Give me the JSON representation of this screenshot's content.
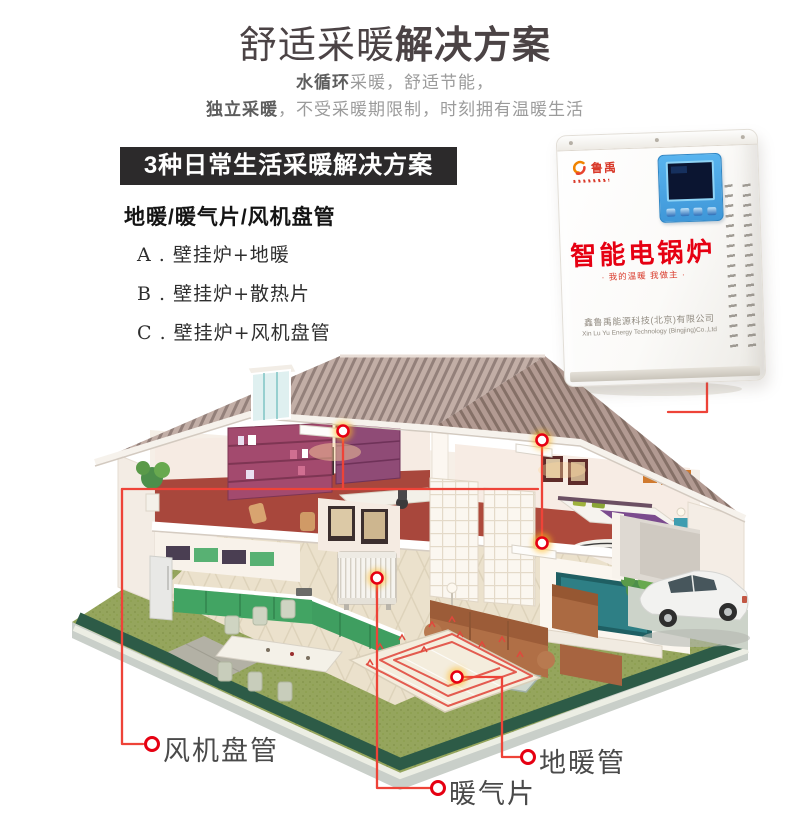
{
  "header": {
    "title_regular": "舒适采暖",
    "title_bold": "解决方案",
    "sub1_bold": "水循环",
    "sub1_rest": "采暖，舒适节能，",
    "sub2_bold": "独立采暖",
    "sub2_rest": "，不受采暖期限制，时刻拥有温暖生活"
  },
  "solutions": {
    "banner": "3种日常生活采暖解决方案",
    "subheading": "地暖/暖气片/风机盘管",
    "items": [
      "A . 壁挂炉+地暖",
      "B . 壁挂炉+散热片",
      "C . 壁挂炉+风机盘管"
    ]
  },
  "boiler": {
    "brand": "鲁禹",
    "product_name": "智能电锅炉",
    "slogan": "· 我的温暖 我做主 ·",
    "company_cn": "鑫鲁禹能源科技(北京)有限公司",
    "company_en": "Xin Lu Yu Energy Technology (Bingjing)Co.,Ltd"
  },
  "callouts": {
    "fan_coil": "风机盘管",
    "radiator": "暖气片",
    "floor_pipe": "地暖管"
  },
  "colors": {
    "accent_red": "#e60012",
    "banner_bg": "#2c2a2b",
    "panel_blue": "#4aa9e8",
    "roof": "#a8948d",
    "grass": "#95a55d",
    "carpet_red": "#a8473c"
  }
}
